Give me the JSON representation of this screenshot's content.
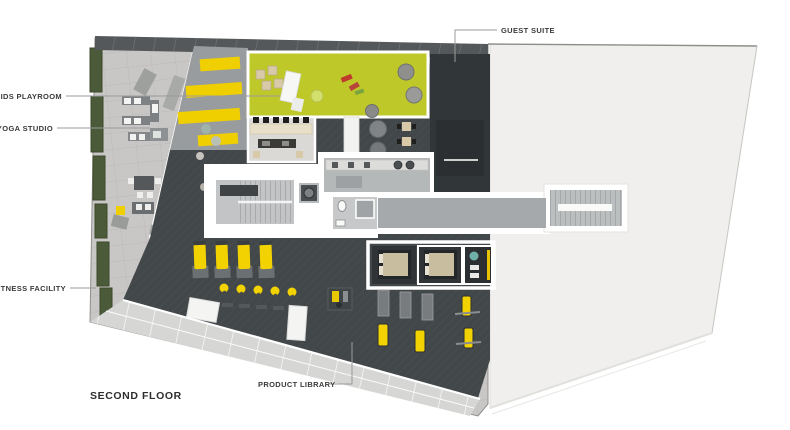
{
  "title": "SECOND FLOOR",
  "labels": {
    "guest_suite": "GUEST SUITE",
    "kids_playroom": "KIDS PLAYROOM",
    "yoga_studio": "YOGA STUDIO",
    "fitness_facility": "FITNESS FACILITY",
    "product_library": "PRODUCT LIBRARY"
  },
  "colors": {
    "kids_green": "#bec829",
    "equipment_yellow": "#f2d200",
    "stripe_yellow": "#f0cf00",
    "charcoal": "#42474a",
    "guest_dark": "#313639",
    "roof": "#f0efed",
    "paver": "#c8c7c5",
    "hedge": "#4b5a38",
    "wall": "#ffffff",
    "core_floor": "#c2c4c6",
    "corridor_floor": "#a6a9ab",
    "band": "#d6d6d4",
    "label": "#3a3a3a",
    "leader": "#9b9b9b"
  }
}
